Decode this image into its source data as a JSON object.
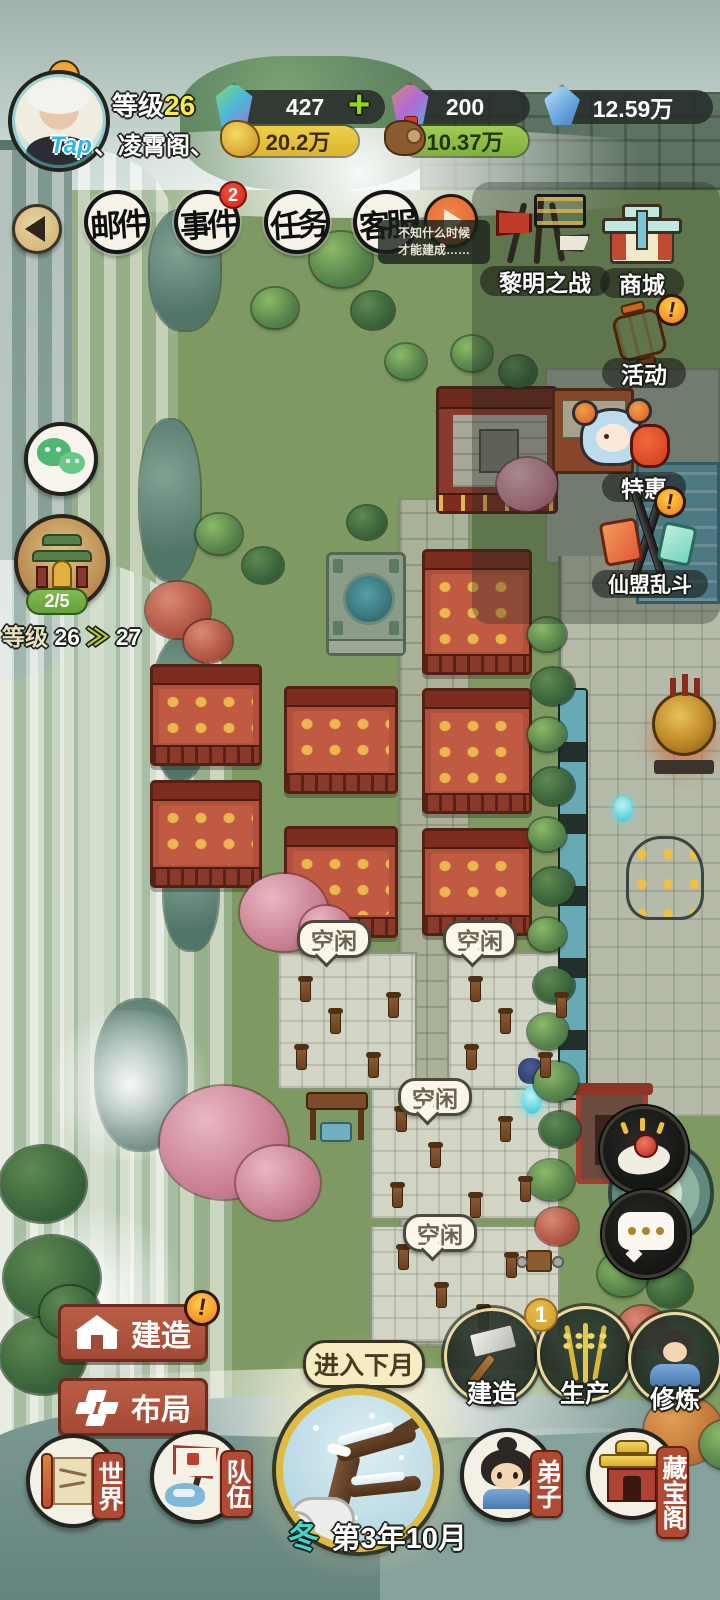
{
  "hud": {
    "avatar_tag": "Tap",
    "level_label": "等级",
    "level_value": "26",
    "sect_name": "、凌霄阁、",
    "resources": {
      "gem": "427",
      "gem_add": "+",
      "gem2": "200",
      "crystal": "12.59万",
      "gold": "20.2万",
      "wood": "10.37万"
    }
  },
  "nav": {
    "items": [
      {
        "label": "邮件",
        "badge": ""
      },
      {
        "label": "事件",
        "badge": "2"
      },
      {
        "label": "任务",
        "badge": ""
      },
      {
        "label": "客服",
        "badge": ""
      }
    ],
    "tooltip": {
      "line1": "不知什么时候",
      "line2": "才能建成……"
    }
  },
  "right_menu": {
    "items": [
      {
        "label": "黎明之战",
        "badge": ""
      },
      {
        "label": "商城",
        "badge": ""
      },
      {
        "label": "活动",
        "badge": "!"
      },
      {
        "label": "特惠",
        "badge": ""
      },
      {
        "label": "仙盟乱斗",
        "badge": "!"
      }
    ]
  },
  "left_widgets": {
    "sect_progress": "2/5",
    "level_label": "等级",
    "level_from": "26",
    "arrow": "≫",
    "level_to": "27"
  },
  "map": {
    "idle_bubbles": [
      "空闲",
      "空闲",
      "空闲",
      "空闲"
    ]
  },
  "build_menu": {
    "build": {
      "label": "建造",
      "badge": "!"
    },
    "layout": {
      "label": "布局"
    }
  },
  "actions": {
    "next_month": "进入下月",
    "build": {
      "label": "建造"
    },
    "produce": {
      "label": "生产",
      "badge": "1"
    },
    "cultivate": {
      "label": "修炼"
    }
  },
  "bottom_nav": {
    "world": "世界",
    "team": "队伍",
    "disciple": "弟子",
    "treasure": "藏宝阁"
  },
  "season": {
    "season": "冬",
    "date": "第3年10月"
  }
}
